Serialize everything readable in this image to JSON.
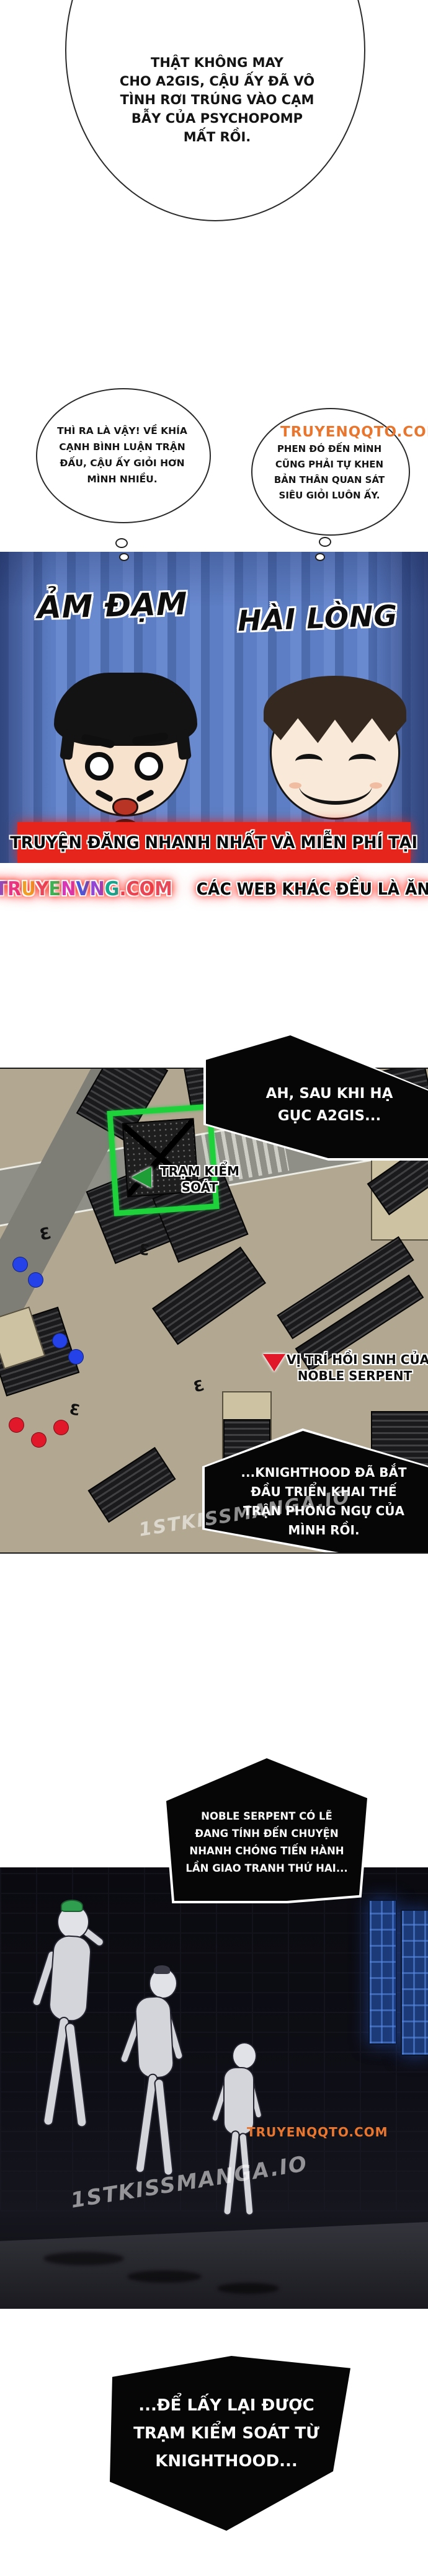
{
  "bubble_psychopomp": {
    "lines": [
      "THẬT KHÔNG MAY",
      "CHO A2GIS, CẬU ẤY ĐÃ VÔ",
      "TÌNH RƠI TRÚNG VÀO CẠM",
      "BẪY CỦA PSYCHOPOMP",
      "MẤT RỒI."
    ]
  },
  "bubble_thi_ra": {
    "lines": [
      "THÌ RA LÀ VẬY! VỀ KHÍA",
      "CẠNH BÌNH LUẬN TRẬN",
      "ĐẤU, CẬU ẤY GIỎI HƠN",
      "MÌNH NHIỀU."
    ]
  },
  "bubble_phen_do": {
    "watermark": "TRUYENQQTO.COM",
    "lines": [
      "PHEN ĐÓ ĐẾN MÌNH",
      "CŨNG PHẢI TỰ KHEN",
      "BẢN THÂN QUAN SÁT",
      "SIÊU GIỎI LUÔN ẤY."
    ]
  },
  "tv_panel": {
    "label_left": "ẢM ĐẠM",
    "label_right": "HÀI LÒNG"
  },
  "banner": {
    "line1": "TRUYỆN ĐĂNG NHANH NHẤT VÀ MIỄN PHÍ TẠI",
    "site_letters": [
      {
        "ch": "N",
        "color": "#2fae4a"
      },
      {
        "ch": "E",
        "color": "#f07c22"
      },
      {
        "ch": "T",
        "color": "#18b8d8"
      },
      {
        "ch": "T",
        "color": "#8a50c8"
      },
      {
        "ch": "R",
        "color": "#e8388a"
      },
      {
        "ch": "U",
        "color": "#f0a028"
      },
      {
        "ch": "Y",
        "color": "#e84a60"
      },
      {
        "ch": "E",
        "color": "#38b858"
      },
      {
        "ch": "N",
        "color": "#d838b8"
      },
      {
        "ch": "V",
        "color": "#4858e0"
      },
      {
        "ch": "N",
        "color": "#9048d8"
      },
      {
        "ch": "G",
        "color": "#18a890"
      },
      {
        "ch": ".",
        "color": "#e84858"
      },
      {
        "ch": "C",
        "color": "#e84858"
      },
      {
        "ch": "O",
        "color": "#e84858"
      },
      {
        "ch": "M",
        "color": "#e84858"
      }
    ],
    "line2": "CÁC WEB KHÁC ĐỀU LÀ ĂN CẮP"
  },
  "caption_after_a2gis": {
    "lines": [
      "AH, SAU KHI HẠ",
      "GỤC A2GIS..."
    ]
  },
  "map": {
    "checkpoint_label_lines": [
      "TRẠM KIỂM",
      "SOÁT"
    ],
    "respawn_label_lines": [
      "VỊ TRÍ HỒI SINH CỦA",
      "NOBLE SERPENT"
    ],
    "watermark": "1STKISSMANGA.IO",
    "colors": {
      "checkpoint_highlight": "#1fd23c",
      "respawn_marker": "#e0182a",
      "blue_dot": "#2442e8",
      "red_dot": "#e0182a"
    }
  },
  "caption_knighthood": {
    "lines": [
      "...KNIGHTHOOD ĐÃ BẮT",
      "ĐẦU TRIỂN KHAI THẾ",
      "TRẬN PHÒNG NGỰ CỦA",
      "MÌNH RỒI."
    ]
  },
  "caption_noble_serpent": {
    "lines": [
      "NOBLE SERPENT CÓ LẼ",
      "ĐANG TÍNH ĐẾN CHUYỆN",
      "NHANH CHÓNG TIẾN HÀNH",
      "LẦN GIAO TRANH THỨ HAI..."
    ]
  },
  "alley_panel": {
    "watermark_top": "TRUYENQQTO.COM",
    "watermark_bottom": "1STKISSMANGA.IO"
  },
  "caption_retake": {
    "lines": [
      "...ĐỂ LẤY LẠI ĐƯỢC",
      "TRẠM KIỂM SOÁT TỪ",
      "KNIGHTHOOD..."
    ]
  }
}
